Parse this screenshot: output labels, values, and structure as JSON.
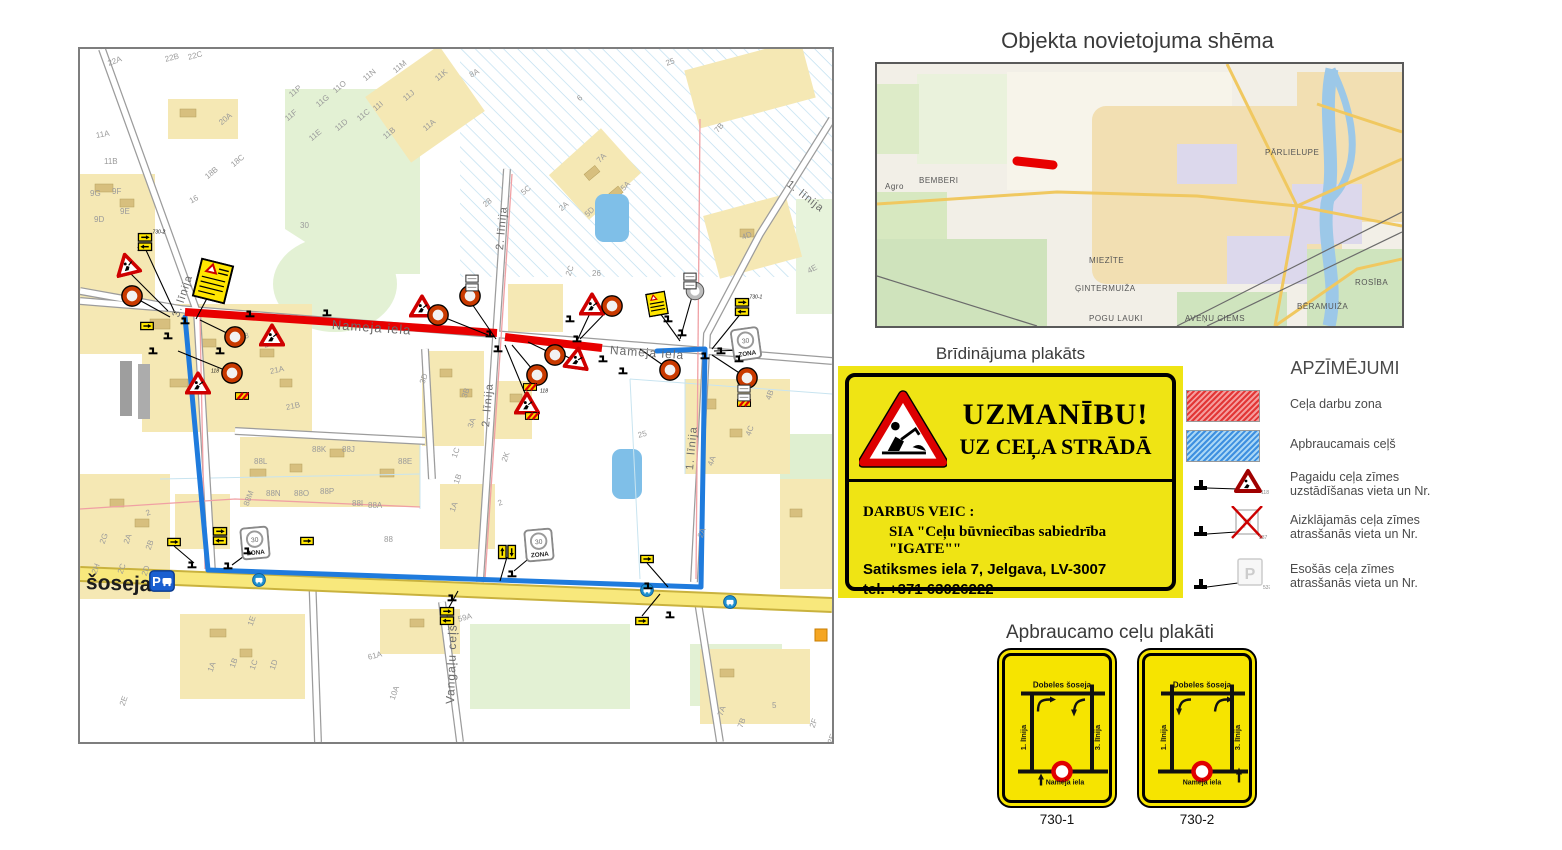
{
  "titles": {
    "overview": "Objekta novietojuma shēma",
    "warning": "Brīdinājuma plakāts",
    "legend": "APZĪMĒJUMI",
    "detour": "Apbraucamo ceļu plakāti"
  },
  "poster": {
    "heading1": "UZMANĪBU!",
    "heading2": "UZ CEĻA STRĀDĀ",
    "body1": "DARBUS VEIC :",
    "body2": "SIA \"Ceļu būvniecības sabiedrība \"IGATE\"\"",
    "body3": "Satiksmes iela 7, Jelgava, LV-3007",
    "body4": "tel. +371 63026222"
  },
  "legend": {
    "item1": "Ceļa darbu zona",
    "item2": "Apbraucamais ceļš",
    "item3a": "Pagaidu ceļa zīmes",
    "item3b": "uzstādīšanas vieta un Nr.",
    "item4a": "Aizklājamās ceļa zīmes",
    "item4b": "atrasšanās vieta un Nr.",
    "item5a": "Esošās ceļa zīmes",
    "item5b": "atrasšanās vieta un Nr.",
    "tri_nr": "118",
    "cross_nr": "537",
    "exist_nr": "537"
  },
  "detour_posters": [
    {
      "id": "730-1",
      "top": "Dobeles šoseja",
      "left": "1. līnija",
      "right": "3. līnija",
      "bottom": "Nameja iela"
    },
    {
      "id": "730-2",
      "top": "Dobeles šoseja",
      "left": "1. līnija",
      "right": "3. līnija",
      "bottom": "Nameja iela"
    }
  ],
  "overview_map": {
    "districts": [
      [
        "BEMBERI",
        42,
        112
      ],
      [
        "PĀRLIELUPE",
        388,
        84
      ],
      [
        "MIEZĪTE",
        212,
        192
      ],
      [
        "ĢINTERMUIŽA",
        198,
        220
      ],
      [
        "POGU LAUKI",
        212,
        250
      ],
      [
        "AVEŅU CIEMS",
        308,
        250
      ],
      [
        "BĒRAMUIŽA",
        420,
        238
      ],
      [
        "ROSĪBA",
        478,
        214
      ],
      [
        "Agro",
        8,
        118
      ]
    ]
  },
  "main_map": {
    "street_labels": [
      [
        "Nameja iela",
        252,
        268,
        4,
        13,
        0
      ],
      [
        "Nameja iela",
        530,
        294,
        4,
        12,
        0
      ],
      [
        "2. līnija",
        420,
        195,
        -85,
        11,
        0
      ],
      [
        "2. līnija",
        406,
        372,
        -85,
        11,
        0
      ],
      [
        "3. līnija",
        96,
        262,
        -72,
        11,
        0
      ],
      [
        "1. līnija",
        708,
        128,
        38,
        11,
        0
      ],
      [
        "1. līnija",
        610,
        415,
        -85,
        11,
        0
      ],
      [
        "Vangaļu ceļš",
        370,
        648,
        -88,
        12,
        0
      ],
      [
        "šoseja",
        6,
        522,
        2,
        21,
        1
      ]
    ],
    "plot_labels": [
      [
        "22A",
        28,
        10,
        -20
      ],
      [
        "22B",
        85,
        6,
        -15
      ],
      [
        "22C",
        108,
        4,
        -15
      ],
      [
        "11A",
        16,
        82,
        -10
      ],
      [
        "11B",
        24,
        108,
        0
      ],
      [
        "9G",
        10,
        140,
        0
      ],
      [
        "9F",
        32,
        138,
        0
      ],
      [
        "9E",
        40,
        158,
        0
      ],
      [
        "9D",
        14,
        166,
        0
      ],
      [
        "20A",
        140,
        70,
        -40
      ],
      [
        "18C",
        152,
        112,
        -40
      ],
      [
        "18B",
        126,
        124,
        -40
      ],
      [
        "16",
        110,
        148,
        -30
      ],
      [
        "30",
        220,
        172,
        0
      ],
      [
        "11P",
        210,
        42,
        -40
      ],
      [
        "11G",
        237,
        52,
        -40
      ],
      [
        "11O",
        254,
        38,
        -40
      ],
      [
        "11F",
        206,
        66,
        -40
      ],
      [
        "11E",
        230,
        86,
        -40
      ],
      [
        "11D",
        256,
        76,
        -40
      ],
      [
        "11C",
        278,
        66,
        -40
      ],
      [
        "11N",
        284,
        26,
        -40
      ],
      [
        "11I",
        294,
        56,
        -40
      ],
      [
        "11B",
        304,
        84,
        -40
      ],
      [
        "11M",
        314,
        18,
        -40
      ],
      [
        "11J",
        324,
        46,
        -40
      ],
      [
        "11A",
        344,
        76,
        -40
      ],
      [
        "11K",
        356,
        26,
        -40
      ],
      [
        "8A",
        390,
        22,
        -30
      ],
      [
        "6",
        498,
        46,
        -40
      ],
      [
        "7B",
        636,
        78,
        -50
      ],
      [
        "7A",
        518,
        108,
        -45
      ],
      [
        "5A",
        542,
        136,
        -45
      ],
      [
        "5D",
        506,
        162,
        -45
      ],
      [
        "5C",
        442,
        140,
        -40
      ],
      [
        "28",
        404,
        152,
        -40
      ],
      [
        "2A",
        480,
        156,
        -40
      ],
      [
        "25",
        586,
        10,
        -20
      ],
      [
        "26",
        512,
        220,
        0
      ],
      [
        "2C",
        488,
        222,
        -70
      ],
      [
        "4E",
        728,
        218,
        -30
      ],
      [
        "4D",
        662,
        184,
        -20
      ],
      [
        "23",
        160,
        284,
        -15
      ],
      [
        "21",
        184,
        292,
        -15
      ],
      [
        "21A",
        190,
        318,
        -12
      ],
      [
        "21B",
        206,
        354,
        -12
      ],
      [
        "88K",
        232,
        396,
        0
      ],
      [
        "88J",
        262,
        396,
        0
      ],
      [
        "88L",
        174,
        408,
        0
      ],
      [
        "88N",
        186,
        440,
        0
      ],
      [
        "88O",
        214,
        440,
        0
      ],
      [
        "88P",
        240,
        438,
        0
      ],
      [
        "88M",
        166,
        452,
        -70
      ],
      [
        "88I",
        272,
        450,
        0
      ],
      [
        "88A",
        288,
        452,
        0
      ],
      [
        "88E",
        318,
        408,
        0
      ],
      [
        "3D",
        342,
        330,
        -70
      ],
      [
        "3B",
        384,
        344,
        -70
      ],
      [
        "3A",
        390,
        374,
        -70
      ],
      [
        "2K",
        424,
        408,
        -70
      ],
      [
        "1C",
        374,
        404,
        -70
      ],
      [
        "1B",
        376,
        430,
        -70
      ],
      [
        "1A",
        372,
        458,
        -70
      ],
      [
        "2",
        418,
        450,
        -20
      ],
      [
        "25",
        558,
        382,
        -15
      ],
      [
        "2A",
        620,
        484,
        -70
      ],
      [
        "4A",
        630,
        412,
        -70
      ],
      [
        "4B",
        688,
        346,
        -70
      ],
      [
        "4C",
        668,
        382,
        -70
      ],
      [
        "88",
        304,
        486,
        0
      ],
      [
        "2",
        66,
        460,
        -20
      ],
      [
        "2G",
        22,
        490,
        -70
      ],
      [
        "2A",
        46,
        490,
        -70
      ],
      [
        "2B",
        68,
        496,
        -70
      ],
      [
        "2H",
        14,
        520,
        -70
      ],
      [
        "2C",
        40,
        520,
        -70
      ],
      [
        "2D",
        64,
        522,
        -70
      ],
      [
        "2E",
        42,
        652,
        -70
      ],
      [
        "1A",
        130,
        618,
        -70
      ],
      [
        "1B",
        152,
        614,
        -70
      ],
      [
        "1C",
        172,
        616,
        -70
      ],
      [
        "1D",
        192,
        616,
        -70
      ],
      [
        "1E",
        170,
        572,
        -70
      ],
      [
        "61A",
        288,
        604,
        -15
      ],
      [
        "59A",
        378,
        566,
        -15
      ],
      [
        "10A",
        312,
        646,
        -70
      ],
      [
        "7A",
        640,
        662,
        -70
      ],
      [
        "7B",
        660,
        674,
        -70
      ],
      [
        "5",
        692,
        652,
        0
      ],
      [
        "2F",
        732,
        674,
        -70
      ],
      [
        "2E",
        750,
        690,
        -70
      ]
    ],
    "signs": [
      [
        "tri",
        47,
        215,
        -14,
        "118"
      ],
      [
        "tri",
        192,
        286,
        0,
        ""
      ],
      [
        "tri",
        118,
        334,
        0,
        "118"
      ],
      [
        "tri",
        342,
        257,
        0,
        ""
      ],
      [
        "tri",
        512,
        255,
        0,
        ""
      ],
      [
        "tri",
        497,
        309,
        8,
        ""
      ],
      [
        "tri",
        447,
        354,
        0,
        "118"
      ],
      [
        "circle",
        52,
        247,
        0,
        ""
      ],
      [
        "circle",
        155,
        288,
        0,
        ""
      ],
      [
        "circle",
        152,
        324,
        0,
        ""
      ],
      [
        "circle",
        358,
        266,
        0,
        ""
      ],
      [
        "circle",
        390,
        247,
        0,
        ""
      ],
      [
        "circle",
        532,
        257,
        0,
        ""
      ],
      [
        "circle",
        475,
        306,
        0,
        ""
      ],
      [
        "circle",
        457,
        326,
        0,
        ""
      ],
      [
        "circle",
        590,
        321,
        0,
        ""
      ],
      [
        "circle",
        667,
        329,
        0,
        ""
      ],
      [
        "gcircle",
        615,
        242,
        0,
        ""
      ],
      [
        "zona30",
        175,
        494,
        -5,
        ""
      ],
      [
        "zona30",
        459,
        496,
        -5,
        ""
      ],
      [
        "zona30",
        666,
        295,
        -8,
        ""
      ],
      [
        "ypair",
        65,
        193,
        0,
        "730-2"
      ],
      [
        "ypair",
        140,
        487,
        0,
        ""
      ],
      [
        "ypair",
        427,
        503,
        90,
        ""
      ],
      [
        "ypair",
        662,
        258,
        0,
        "730-1"
      ],
      [
        "ypair",
        367,
        567,
        0,
        ""
      ],
      [
        "ysingle",
        67,
        277,
        0,
        ""
      ],
      [
        "ysingle",
        94,
        493,
        0,
        ""
      ],
      [
        "ysingle",
        227,
        492,
        0,
        ""
      ],
      [
        "ysingle",
        567,
        510,
        0,
        ""
      ],
      [
        "ysingle",
        562,
        572,
        0,
        ""
      ],
      [
        "stripe",
        162,
        347,
        0,
        ""
      ],
      [
        "stripe",
        450,
        338,
        0,
        ""
      ],
      [
        "stripe",
        452,
        367,
        0,
        ""
      ],
      [
        "stripe",
        664,
        354,
        0,
        ""
      ],
      [
        "wpair",
        392,
        234,
        0,
        ""
      ],
      [
        "wpair",
        610,
        232,
        0,
        ""
      ],
      [
        "wpair",
        664,
        344,
        0,
        ""
      ],
      [
        "poster",
        133,
        232,
        14,
        ""
      ],
      [
        "minposter",
        577,
        255,
        -10,
        ""
      ],
      [
        "pbus",
        82,
        532,
        0,
        ""
      ],
      [
        "bus",
        179,
        531,
        0,
        ""
      ],
      [
        "bus",
        567,
        541,
        0,
        ""
      ],
      [
        "bus",
        650,
        553,
        0,
        ""
      ],
      [
        "pole",
        105,
        272,
        0,
        ""
      ],
      [
        "pole",
        88,
        287,
        0,
        ""
      ],
      [
        "pole",
        73,
        302,
        0,
        ""
      ],
      [
        "pole",
        140,
        302,
        0,
        ""
      ],
      [
        "pole",
        170,
        265,
        0,
        ""
      ],
      [
        "pole",
        247,
        264,
        0,
        ""
      ],
      [
        "pole",
        410,
        285,
        0,
        ""
      ],
      [
        "pole",
        418,
        300,
        0,
        ""
      ],
      [
        "pole",
        490,
        270,
        0,
        ""
      ],
      [
        "pole",
        497,
        290,
        0,
        ""
      ],
      [
        "pole",
        523,
        310,
        0,
        ""
      ],
      [
        "pole",
        543,
        322,
        0,
        ""
      ],
      [
        "pole",
        588,
        270,
        0,
        ""
      ],
      [
        "pole",
        602,
        284,
        0,
        ""
      ],
      [
        "pole",
        641,
        302,
        0,
        ""
      ],
      [
        "pole",
        659,
        310,
        0,
        ""
      ],
      [
        "pole",
        625,
        307,
        0,
        ""
      ],
      [
        "pole",
        168,
        502,
        0,
        ""
      ],
      [
        "pole",
        148,
        517,
        0,
        ""
      ],
      [
        "pole",
        372,
        549,
        0,
        ""
      ],
      [
        "pole",
        432,
        525,
        0,
        ""
      ],
      [
        "pole",
        568,
        537,
        0,
        ""
      ],
      [
        "pole",
        590,
        566,
        0,
        ""
      ],
      [
        "pole",
        112,
        516,
        0,
        ""
      ]
    ],
    "leaders": [
      [
        52,
        247,
        90,
        268
      ],
      [
        155,
        288,
        120,
        271
      ],
      [
        152,
        324,
        98,
        302
      ],
      [
        47,
        221,
        88,
        262
      ],
      [
        358,
        266,
        408,
        286
      ],
      [
        390,
        252,
        416,
        290
      ],
      [
        475,
        306,
        448,
        293
      ],
      [
        457,
        326,
        432,
        296
      ],
      [
        532,
        257,
        500,
        290
      ],
      [
        512,
        260,
        497,
        292
      ],
      [
        590,
        321,
        560,
        300
      ],
      [
        667,
        329,
        632,
        306
      ],
      [
        666,
        301,
        634,
        302
      ],
      [
        662,
        263,
        632,
        300
      ],
      [
        615,
        237,
        600,
        290
      ],
      [
        577,
        260,
        600,
        292
      ],
      [
        447,
        349,
        425,
        296
      ],
      [
        497,
        313,
        472,
        300
      ],
      [
        175,
        499,
        152,
        516
      ],
      [
        459,
        501,
        434,
        522
      ],
      [
        427,
        508,
        420,
        532
      ],
      [
        94,
        497,
        114,
        514
      ],
      [
        367,
        562,
        378,
        542
      ],
      [
        562,
        567,
        580,
        545
      ],
      [
        567,
        514,
        588,
        538
      ],
      [
        65,
        199,
        95,
        264
      ],
      [
        133,
        238,
        116,
        270
      ]
    ]
  }
}
